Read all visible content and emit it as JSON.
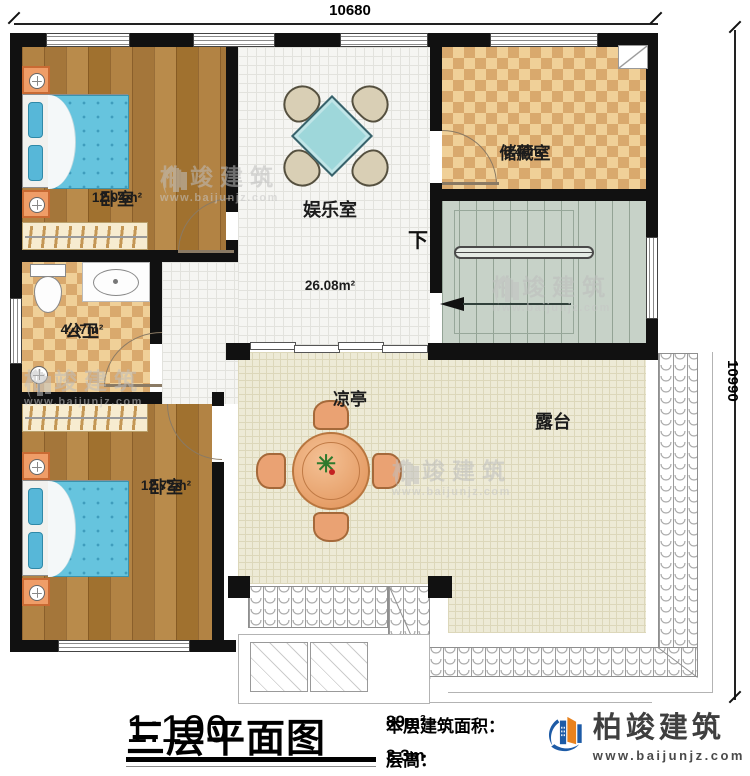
{
  "dimensions": {
    "top": "10680",
    "right": "10990"
  },
  "rooms": {
    "bedroom1": {
      "name": "卧室",
      "area": "12.04m²"
    },
    "entertainment": {
      "name": "娱乐室",
      "area": "26.08m²"
    },
    "storage": {
      "name": "储藏室",
      "area": "8.40m²"
    },
    "bathroom": {
      "name": "公卫",
      "area": "4.47m²"
    },
    "bedroom2": {
      "name": "卧室",
      "area": "12.72m²"
    },
    "pavilion": {
      "name": "凉亭"
    },
    "terrace": {
      "name": "露台"
    }
  },
  "stairs": {
    "direction_label": "下"
  },
  "titleblock": {
    "title": "三层平面图",
    "scale": "1:100",
    "area_label": "本层建筑面积：",
    "area_value": "89m²",
    "height_label": "层高：",
    "height_value": "3.3m"
  },
  "brand": {
    "name": "柏竣建筑",
    "website": "www.baijunjz.com"
  },
  "watermark": {
    "name": "柏竣建筑",
    "website": "www.baijunjz.com"
  },
  "colors": {
    "wall": "#111111",
    "wood_floor": "#ab7a3c",
    "checker_light": "#f0d098",
    "checker_dark": "#d9a96d",
    "hall_floor": "#f5f5f2",
    "stair_floor": "#c7d2c8",
    "terrace_floor": "#edead6",
    "bed_blue": "#66c4de",
    "brand_blue": "#1d5ba6",
    "brand_orange": "#e8821e"
  }
}
